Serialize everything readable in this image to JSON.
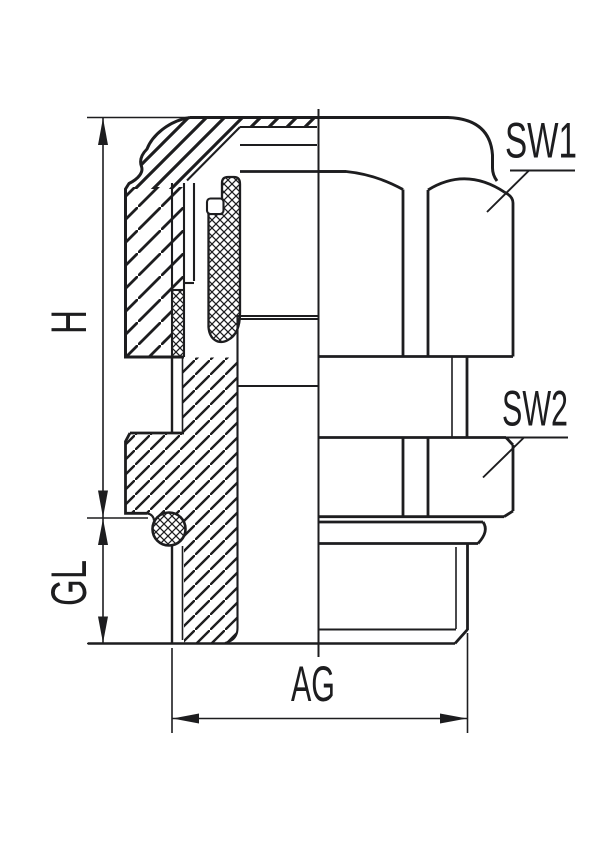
{
  "drawing": {
    "type": "technical-sectional-drawing",
    "subject": "cable gland half-section with dimensions",
    "ink_color": "#1d1d1f",
    "background_color": "#ffffff",
    "labels": {
      "sw1": "SW1",
      "sw2": "SW2",
      "height": "H",
      "thread_length": "GL",
      "thread_size": "AG"
    },
    "dimensions": [
      {
        "name": "H",
        "orientation": "vertical",
        "meaning": "overall body height"
      },
      {
        "name": "GL",
        "orientation": "vertical",
        "meaning": "thread length"
      },
      {
        "name": "AG",
        "orientation": "horizontal",
        "meaning": "connection thread diameter"
      },
      {
        "name": "SW1",
        "orientation": "leader",
        "meaning": "wrench size of cap nut"
      },
      {
        "name": "SW2",
        "orientation": "leader",
        "meaning": "wrench size of body hex"
      }
    ]
  }
}
